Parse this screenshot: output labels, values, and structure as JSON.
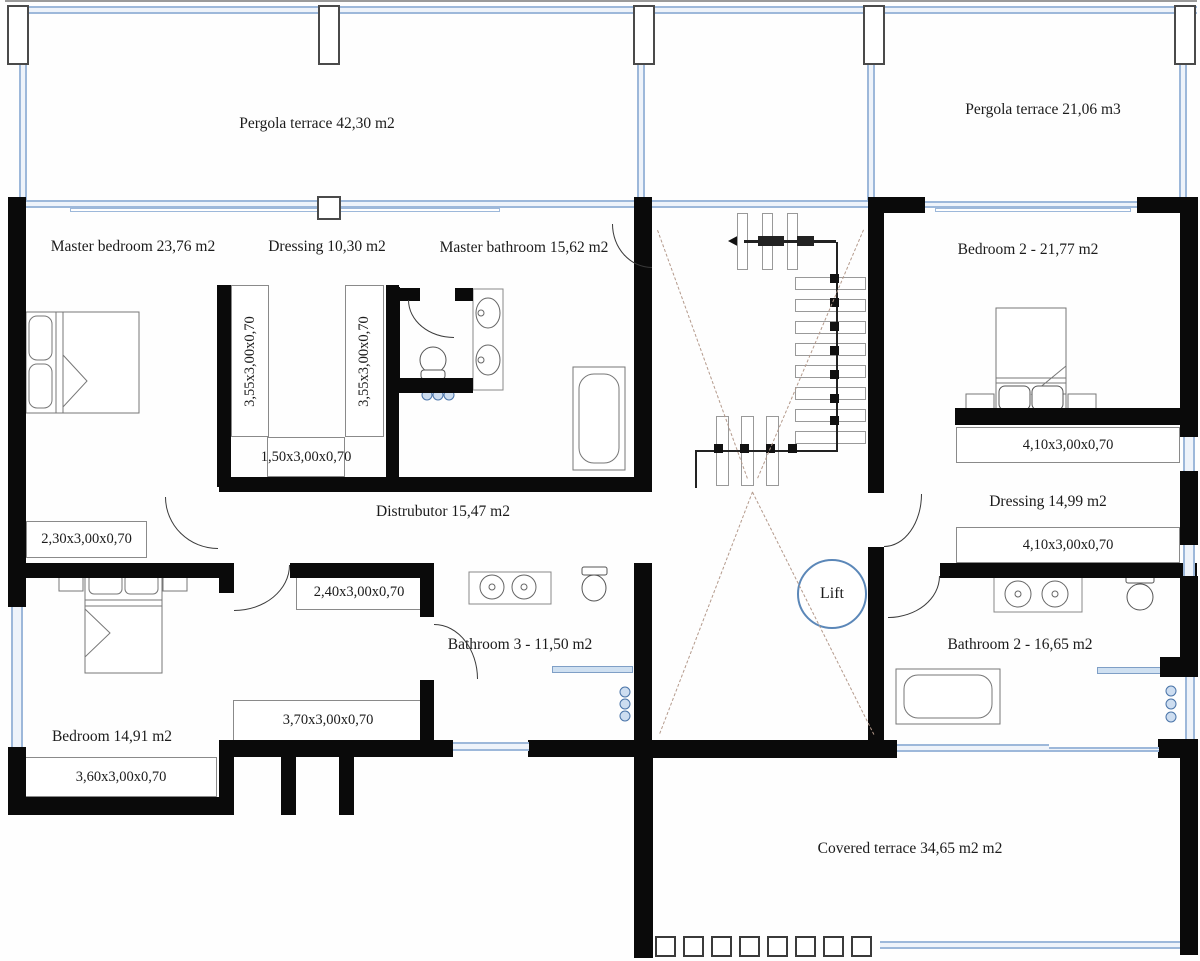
{
  "plan_title": "Upper floor plan",
  "rooms": {
    "pergola_left": "Pergola terrace 42,30 m2",
    "pergola_right": "Pergola terrace 21,06 m3",
    "master_bedroom": "Master bedroom 23,76 m2",
    "dressing1": "Dressing 10,30 m2",
    "master_bathroom": "Master bathroom 15,62 m2",
    "bedroom2": "Bedroom 2 -  21,77 m2",
    "distributor": "Distrubutor 15,47 m2",
    "dressing2": "Dressing 14,99 m2",
    "bathroom3": "Bathroom 3 - 11,50 m2",
    "bathroom2": "Bathroom 2 -  16,65 m2",
    "bedroom": "Bedroom 14,91 m2",
    "covered_terrace": "Covered terrace 34,65 m2 m2",
    "lift": "Lift"
  },
  "closets": {
    "c355_left": "3,55x3,00x0,70",
    "c355_right": "3,55x3,00x0,70",
    "c150": "1,50x3,00x0,70",
    "c230": "2,30x3,00x0,70",
    "c240": "2,40x3,00x0,70",
    "c370": "3,70x3,00x0,70",
    "c360": "3,60x3,00x0,70",
    "c410_top": "4,10x3,00x0,70",
    "c410_bottom": "4,10x3,00x0,70"
  },
  "colors": {
    "wall": "#0a0a0a",
    "window_blue": "#9db8da",
    "lift_ring": "#5b87b8",
    "stair_dash": "#b49a8c"
  }
}
